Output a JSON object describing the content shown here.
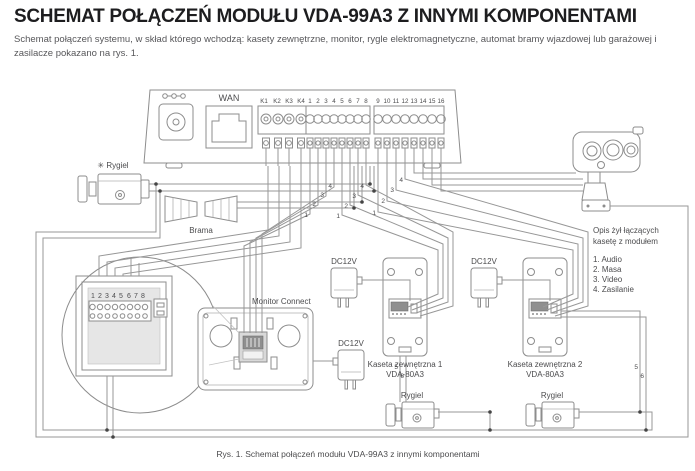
{
  "header": {
    "title": "SCHEMAT POŁĄCZEŃ MODUŁU VDA-99A3 Z INNYMI KOMPONENTAMI",
    "subtitle": "Schemat połączeń systemu, w skład którego wchodzą: kasety zewnętrzne, monitor, rygle elektromagnetyczne, automat bramy wjazdowej lub garażowej i zasilacze pokazano na rys. 1."
  },
  "module": {
    "wan": "WAN",
    "k_terminals": [
      "K1",
      "K2",
      "K3",
      "K4"
    ],
    "terminals_1_8": [
      "1",
      "2",
      "3",
      "4",
      "5",
      "6",
      "7",
      "8"
    ],
    "terminals_9_16": [
      "9",
      "10",
      "11",
      "12",
      "13",
      "14",
      "15",
      "16"
    ]
  },
  "components": {
    "rygiel_top_label": "✳ Rygiel",
    "brama": "Brama",
    "monitor": "Monitor Connect",
    "dc12v": "DC12V",
    "kaseta1": {
      "name": "Kaseta zewnętrzna 1",
      "model": "VDA-80A3"
    },
    "kaseta2": {
      "name": "Kaseta zewnętrzna 2",
      "model": "VDA-80A3"
    },
    "rygiel_b1": "Rygiel",
    "rygiel_b2": "Rygiel",
    "detail_terminals": [
      "1",
      "2",
      "3",
      "4",
      "5",
      "6",
      "7",
      "8"
    ]
  },
  "legend": {
    "title1": "Opis żył łączących",
    "title2": "kasetę z modułem",
    "items": [
      "1. Audio",
      "2. Masa",
      "3. Video",
      "4. Zasilanie"
    ]
  },
  "wires": {
    "n1": "1",
    "n2": "2",
    "n3": "3",
    "n4": "4",
    "n5": "5",
    "n6": "6"
  },
  "caption": "Rys. 1. Schemat połączeń modułu VDA-99A3 z innymi komponentami",
  "colors": {
    "line": "#979797",
    "text": "#4c4c4e",
    "title": "#1d1d1f"
  }
}
